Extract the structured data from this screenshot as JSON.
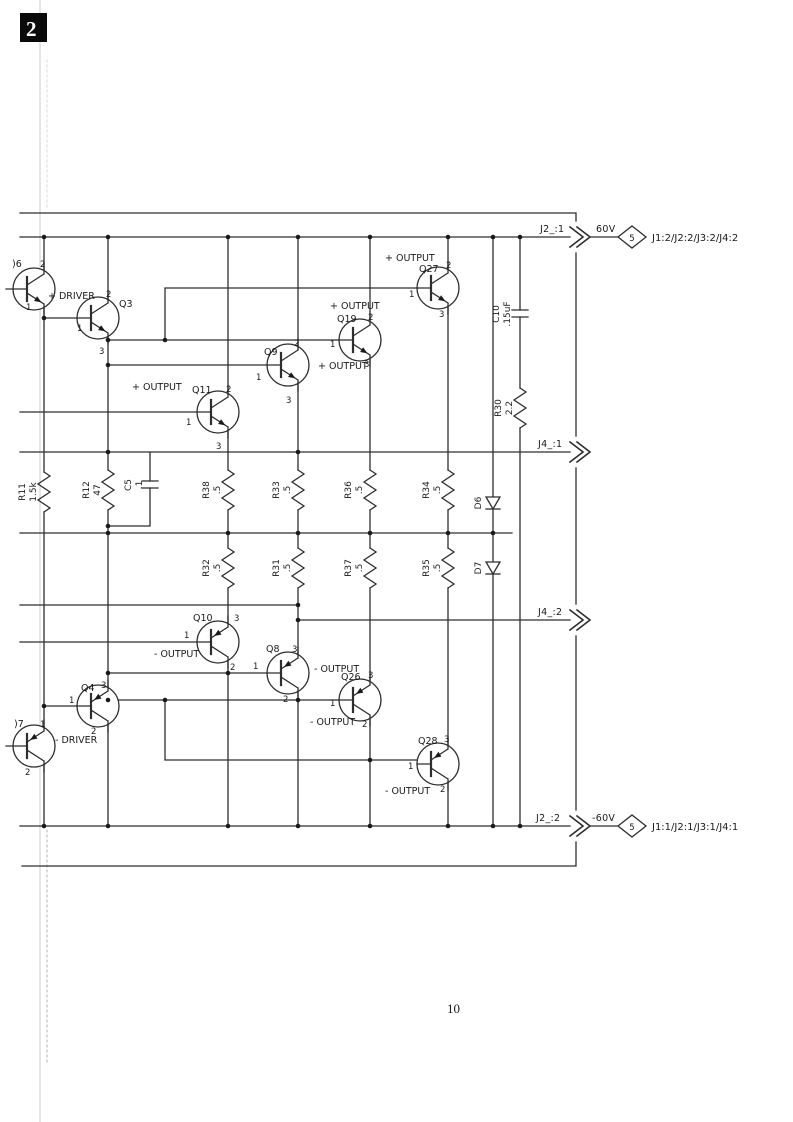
{
  "page": {
    "corner_label": "2",
    "page_number": "10"
  },
  "connectors": {
    "top_rail": {
      "net": "J2_:1",
      "voltage": "60V",
      "page_ref": "5",
      "destination": "J1:2/J2:2/J3:2/J4:2"
    },
    "bottom_rail": {
      "net": "J2_:2",
      "voltage": "-60V",
      "page_ref": "5",
      "destination": "J1:1/J2:1/J3:1/J4:1"
    },
    "output_rail_1": {
      "net": "J4_:1"
    },
    "output_rail_2": {
      "net": "J4_:2"
    }
  },
  "transistors": {
    "q6": {
      "ref": ")6",
      "pin1": "1",
      "pin2": "2"
    },
    "q3": {
      "ref": "Q3",
      "role": "+ DRIVER",
      "pin1": "1",
      "pin2": "2",
      "pin3": "3"
    },
    "q11": {
      "ref": "Q11",
      "role": "+ OUTPUT",
      "pin1": "1",
      "pin2": "2",
      "pin3": "3"
    },
    "q9": {
      "ref": "Q9",
      "role": "+ OUTPUT",
      "pin1": "1",
      "pin2": "2",
      "pin3": "3"
    },
    "q19": {
      "ref": "Q19",
      "role": "+ OUTPUT",
      "pin1": "1",
      "pin2": "2",
      "pin3": "3"
    },
    "q27": {
      "ref": "Q27",
      "role": "+ OUTPUT",
      "pin1": "1",
      "pin2": "2",
      "pin3": "3"
    },
    "q10": {
      "ref": "Q10",
      "role": "- OUTPUT",
      "pin1": "1",
      "pin2": "2",
      "pin3": "3"
    },
    "q8": {
      "ref": "Q8",
      "role": "- OUTPUT",
      "pin1": "1",
      "pin2": "2",
      "pin3": "3"
    },
    "q26": {
      "ref": "Q26",
      "role": "- OUTPUT",
      "pin1": "1",
      "pin2": "2",
      "pin3": "3"
    },
    "q28": {
      "ref": "Q28",
      "role": "- OUTPUT",
      "pin1": "1",
      "pin2": "2",
      "pin3": "3"
    },
    "q4": {
      "ref": "Q4",
      "role": "- DRIVER",
      "pin1": "1",
      "pin2": "2",
      "pin3": "3"
    },
    "q7": {
      "ref": ")7",
      "pin1": "1",
      "pin2": "2"
    }
  },
  "resistors": {
    "r11": {
      "ref": "R11",
      "value": "1.5k"
    },
    "r12": {
      "ref": "R12",
      "value": "47"
    },
    "r30": {
      "ref": "R30",
      "value": "2.2"
    },
    "r31": {
      "ref": "R31",
      "value": ".5"
    },
    "r32": {
      "ref": "R32",
      "value": ".5"
    },
    "r33": {
      "ref": "R33",
      "value": ".5"
    },
    "r34": {
      "ref": "R34",
      "value": ".5"
    },
    "r35": {
      "ref": "R35",
      "value": ".5"
    },
    "r36": {
      "ref": "R36",
      "value": ".5"
    },
    "r37": {
      "ref": "R37",
      "value": ".5"
    },
    "r38": {
      "ref": "R38",
      "value": ".5"
    }
  },
  "capacitors": {
    "c5": {
      "ref": "C5",
      "value": ".1"
    },
    "c10": {
      "ref": "C10",
      "value": ".15uF"
    }
  },
  "diodes": {
    "d6": {
      "ref": "D6"
    },
    "d7": {
      "ref": "D7"
    }
  }
}
